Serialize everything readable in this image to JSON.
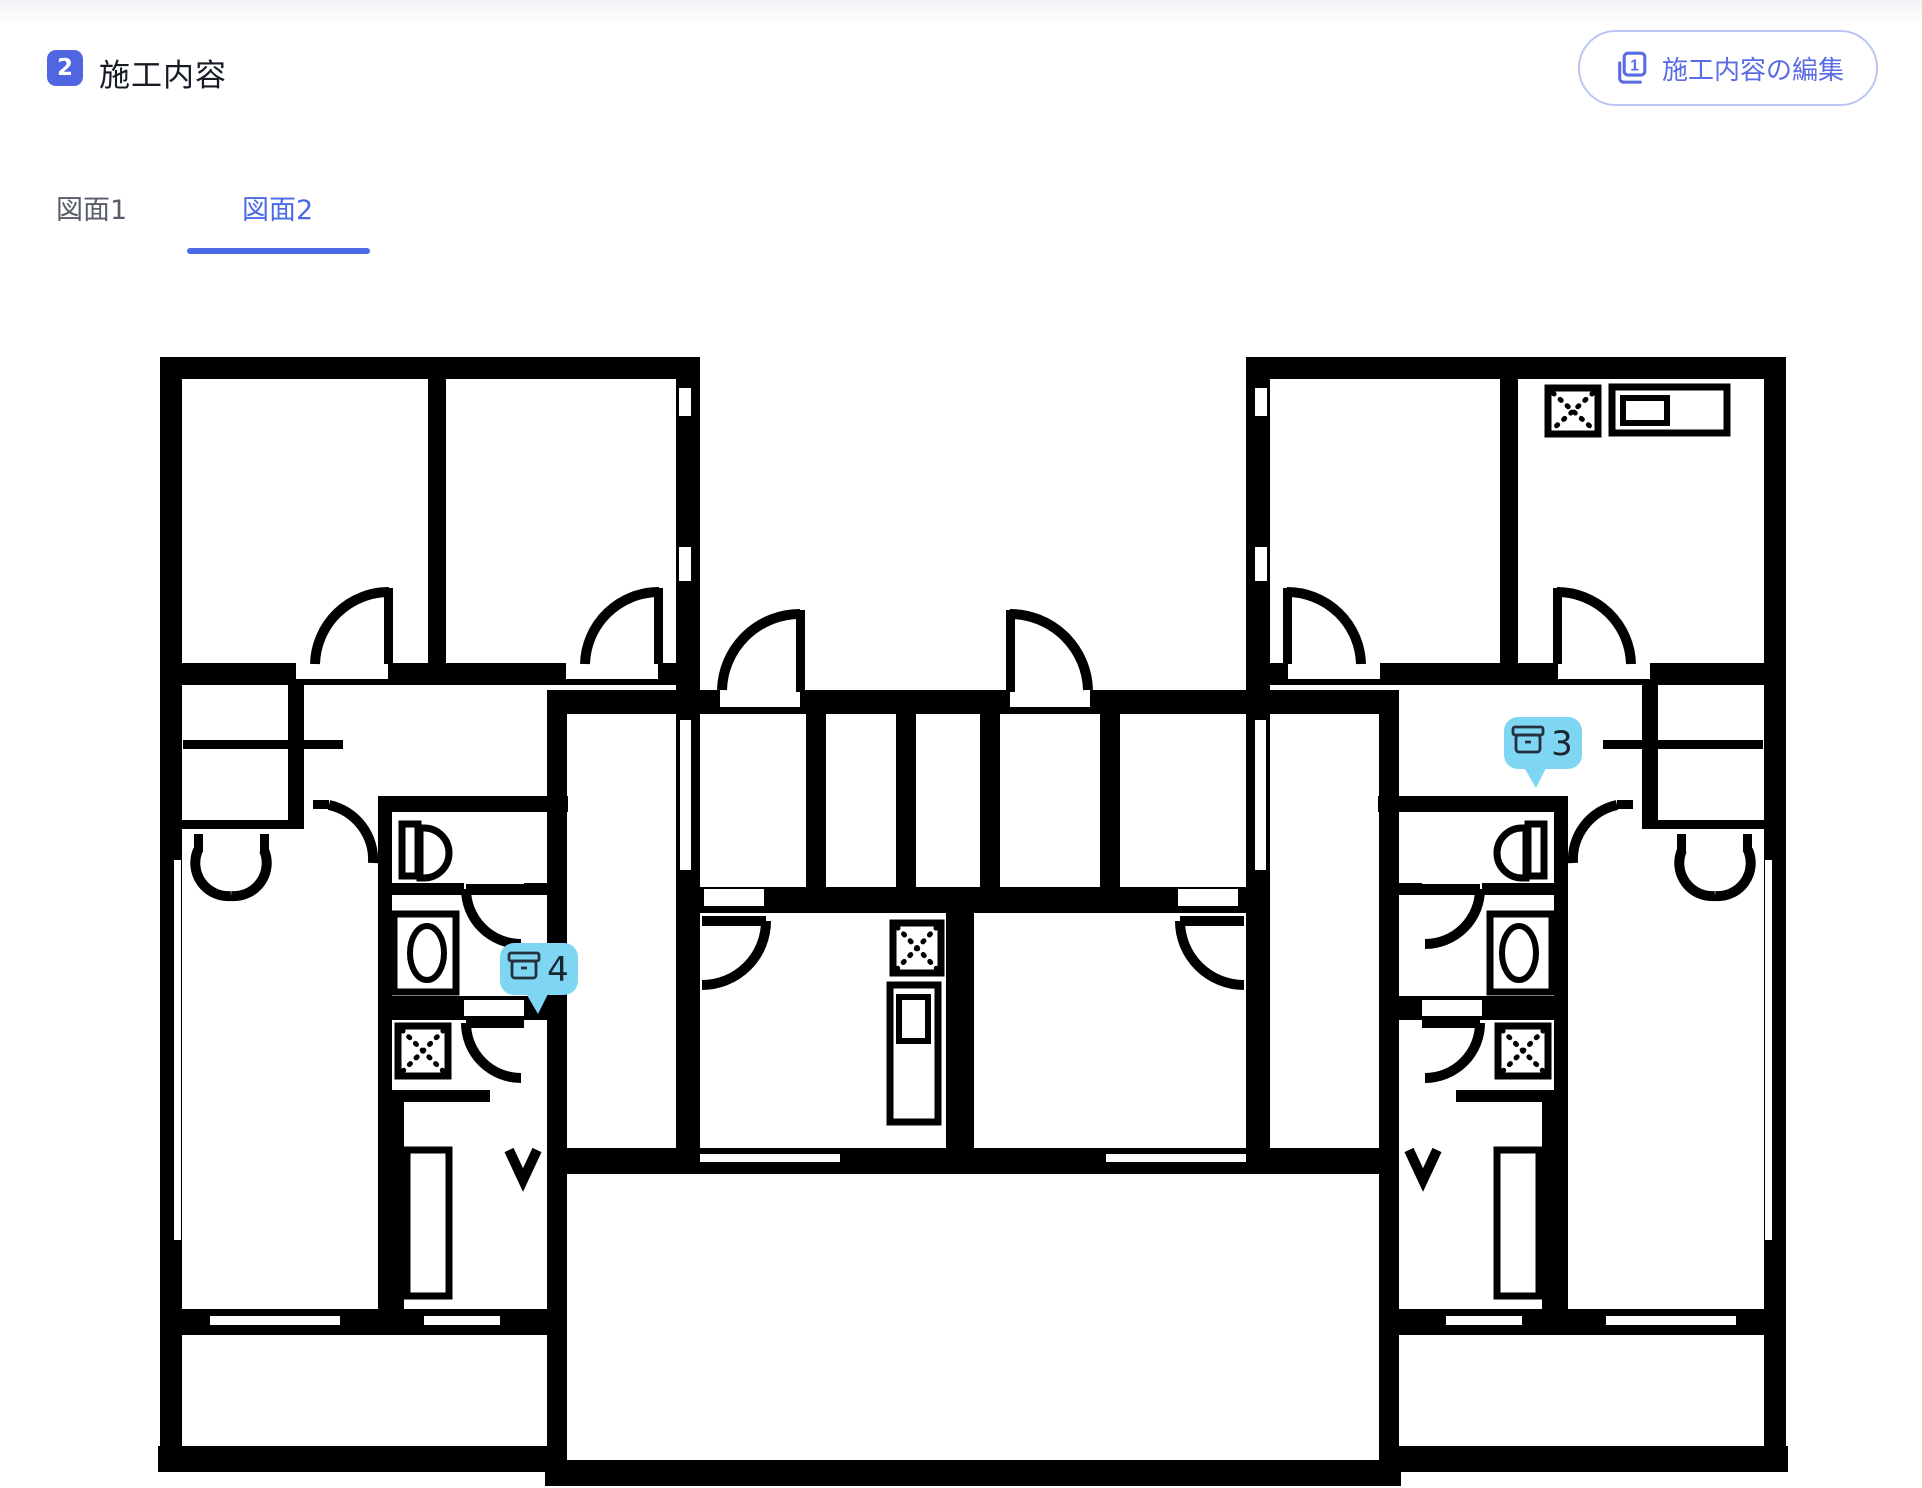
{
  "header": {
    "step_number": "2",
    "title": "施工内容",
    "edit_button": {
      "label": "施工内容の編集",
      "icon": "copy-page-1-icon"
    }
  },
  "tabs": [
    {
      "label": "図面1",
      "active": false
    },
    {
      "label": "図面2",
      "active": true
    }
  ],
  "floor_plan": {
    "description": "Black-and-white architectural floor plan of two mirrored apartment units with central shared rooms",
    "symbols": [
      "toilet",
      "washing-machine",
      "stove-x-box",
      "kitchen-sink-counter",
      "door-swing-arcs",
      "double-swing-doors",
      "storage-box"
    ],
    "markers": [
      {
        "id": "marker-3",
        "count": "3",
        "icon": "storage-box-icon",
        "color": "#7ed6f2"
      },
      {
        "id": "marker-4",
        "count": "4",
        "icon": "storage-box-icon",
        "color": "#7ed6f2"
      }
    ]
  },
  "colors": {
    "step_badge": "#5065e2",
    "tab_active": "#4a6be5",
    "tab_inactive": "#565d69",
    "edit_button_border": "#bcc6f5",
    "edit_button_text": "#5a6ce4",
    "marker_fill": "#7ed6f2",
    "marker_text": "#1a2530",
    "walls": "#000000"
  }
}
